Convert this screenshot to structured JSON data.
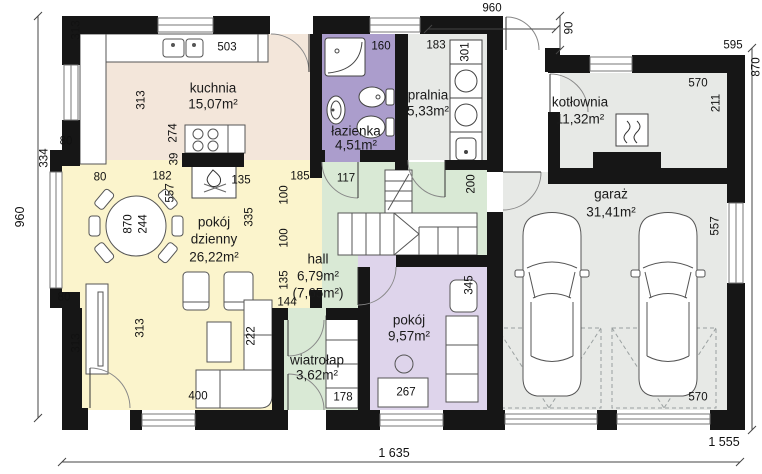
{
  "plan_title": "parter - rzut kondygnacji",
  "rooms": {
    "kuchnia": {
      "name": "kuchnia",
      "area": "15,07m²"
    },
    "lazienka": {
      "name": "łazienka",
      "area": "4,51m²"
    },
    "pralnia": {
      "name": "pralnia",
      "area": "5,33m²"
    },
    "kotlownia": {
      "name": "kotłownia",
      "area": "11,32m²"
    },
    "pokoj_dzienny": {
      "name_line1": "pokój",
      "name_line2": "dzienny",
      "area": "26,22m²"
    },
    "hall": {
      "name": "hall",
      "area": "6,79m²",
      "area_alt": "(7,65m²)"
    },
    "wiatrolap": {
      "name": "wiatrołap",
      "area": "3,62m²"
    },
    "pokoj": {
      "name": "pokój",
      "area": "9,57m²"
    },
    "garaz": {
      "name": "garaż",
      "area": "31,41m²"
    }
  },
  "dims": {
    "d960_top": "960",
    "d90": "90",
    "d595": "595",
    "d870_right": "870",
    "d570_kotlownia": "570",
    "d211": "211",
    "d503": "503",
    "d160": "160",
    "d183": "183",
    "d301": "301",
    "d313_topleft": "313",
    "d334": "334",
    "d80_left_top": "80",
    "d80_left_bottom": "80",
    "d313_bottomleft": "313",
    "d960_left": "960",
    "d313_kitchen": "313",
    "d274": "274",
    "d39": "39",
    "d80_table": "80",
    "d182": "182",
    "d557_table": "557",
    "d135_fireplace": "135",
    "d185": "185",
    "d117": "117",
    "d100_a": "100",
    "d100_b": "100",
    "d335": "335",
    "d870_table": "870",
    "d244": "244",
    "d313_tv": "313",
    "d222": "222",
    "d400": "400",
    "d135_hall": "135",
    "d144": "144",
    "d200": "200",
    "d345": "345",
    "d178": "178",
    "d267": "267",
    "d557_garage": "557",
    "d570_garage": "570",
    "d1555": "1 555",
    "d1635": "1 635"
  },
  "colors": {
    "wall": "#161616",
    "kuchnia": "#f3e6da",
    "pokoj_dzienny": "#fbf4cc",
    "hall": "#d9e9d5",
    "wiatrolap": "#d9e9d5",
    "lazienka": "#ab9dcc",
    "pralnia": "#e7e9e6",
    "kotlownia": "#e7e9e6",
    "garaz": "#e7e9e6",
    "pokoj": "#ded4eb"
  },
  "icons": {
    "boiler": "boiler-icon",
    "fireplace": "fireplace-icon",
    "car": "car-top-view-icon",
    "hob": "cooktop-icon",
    "sink": "sink-icon",
    "shower": "shower-icon"
  }
}
